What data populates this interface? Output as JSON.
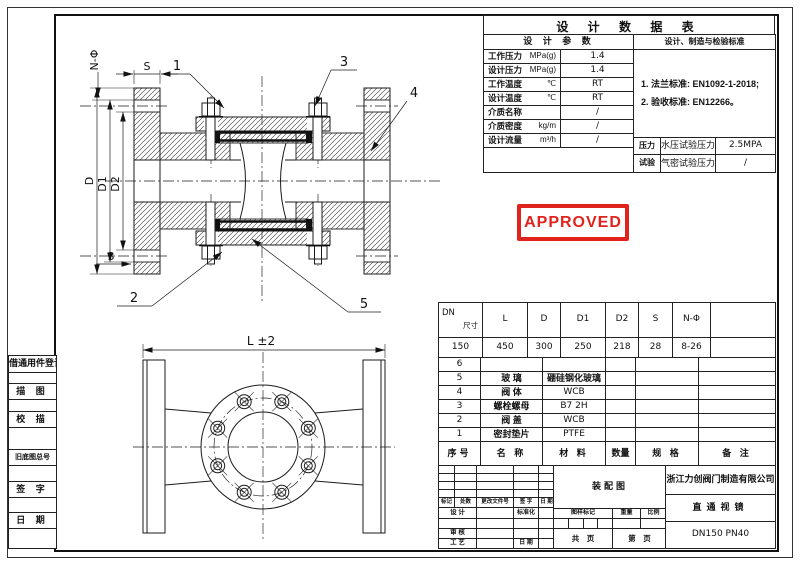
{
  "stamp": {
    "text": "APPROVED",
    "color": "#e0231c"
  },
  "design_table": {
    "title": "设 计 数 据 表",
    "params_header": "设 计 参 数",
    "standards_header": "设计、制造与检验标准",
    "rows": [
      {
        "label": "工作压力",
        "unit": "MPa(g)",
        "value": "1.4"
      },
      {
        "label": "设计压力",
        "unit": "MPa(g)",
        "value": "1.4"
      },
      {
        "label": "工作温度",
        "unit": "℃",
        "value": "RT"
      },
      {
        "label": "设计温度",
        "unit": "℃",
        "value": "RT"
      },
      {
        "label": "介质名称",
        "unit": "",
        "value": "/"
      },
      {
        "label": "介质密度",
        "unit": "kg/m",
        "value": "/"
      },
      {
        "label": "设计流量",
        "unit": "m³/h",
        "value": "/"
      }
    ],
    "notes": [
      "1. 法兰标准: EN1092-1-2018;",
      "2. 验收标准: EN12266。"
    ],
    "test_group": {
      "top": "压力",
      "bottom": "试验"
    },
    "test_rows": [
      {
        "label": "水压试验压力 MPa(g)",
        "value": "2.5MPA"
      },
      {
        "label": "气密试验压力 MPa(g)",
        "value": "/"
      }
    ]
  },
  "dim_table": {
    "corner_top": "尺寸",
    "corner_bottom": "DN",
    "columns": [
      "L",
      "D",
      "D1",
      "D2",
      "S",
      "N-Φ",
      ""
    ],
    "dn": "150",
    "values": [
      "450",
      "300",
      "250",
      "218",
      "28",
      "8-26",
      ""
    ]
  },
  "parts_table": {
    "rows": [
      {
        "no": "6",
        "name": "",
        "material": "",
        "qty": "",
        "spec": "",
        "note": ""
      },
      {
        "no": "5",
        "name": "玻 璃",
        "material": "硼硅钢化玻璃",
        "qty": "",
        "spec": "",
        "note": ""
      },
      {
        "no": "4",
        "name": "阀 体",
        "material": "WCB",
        "qty": "",
        "spec": "",
        "note": ""
      },
      {
        "no": "3",
        "name": "螺栓螺母",
        "material": "B7 2H",
        "qty": "",
        "spec": "",
        "note": ""
      },
      {
        "no": "2",
        "name": "阀 盖",
        "material": "WCB",
        "qty": "",
        "spec": "",
        "note": ""
      },
      {
        "no": "1",
        "name": "密封垫片",
        "material": "PTFE",
        "qty": "",
        "spec": "",
        "note": ""
      }
    ],
    "footer": {
      "no": "序号",
      "name": "名 称",
      "material": "材 料",
      "qty": "数量",
      "spec": "规 格",
      "note": "备 注"
    }
  },
  "title_block": {
    "rev_cols": [
      "标记",
      "处数",
      "更改文件号",
      "签 字",
      "日 期"
    ],
    "design_label": "设 计",
    "standardize_label": "标准化",
    "check_label": "审 核",
    "process_label": "工 艺",
    "date_label": "日 期",
    "mark_label": "图样标记",
    "weight_label": "重量",
    "scale_label": "比例",
    "total_label": "共　页",
    "page_label": "第　页",
    "doc_type": "装配图",
    "company": "浙江力创阀门制造有限公司",
    "product": "直通视镜",
    "model": "DN150 PN40"
  },
  "sidebar": {
    "items": [
      "借通用件登记",
      "描 图",
      "校 描",
      "旧底图总号",
      "签 字",
      "日 期"
    ]
  },
  "drawing": {
    "callouts": [
      "1",
      "2",
      "3",
      "4",
      "5"
    ],
    "dims": {
      "d": "D",
      "d1": "D1",
      "d2": "D2",
      "s": "S",
      "n_phi": "N-Φ",
      "face": "3",
      "length": "L ±2"
    }
  }
}
